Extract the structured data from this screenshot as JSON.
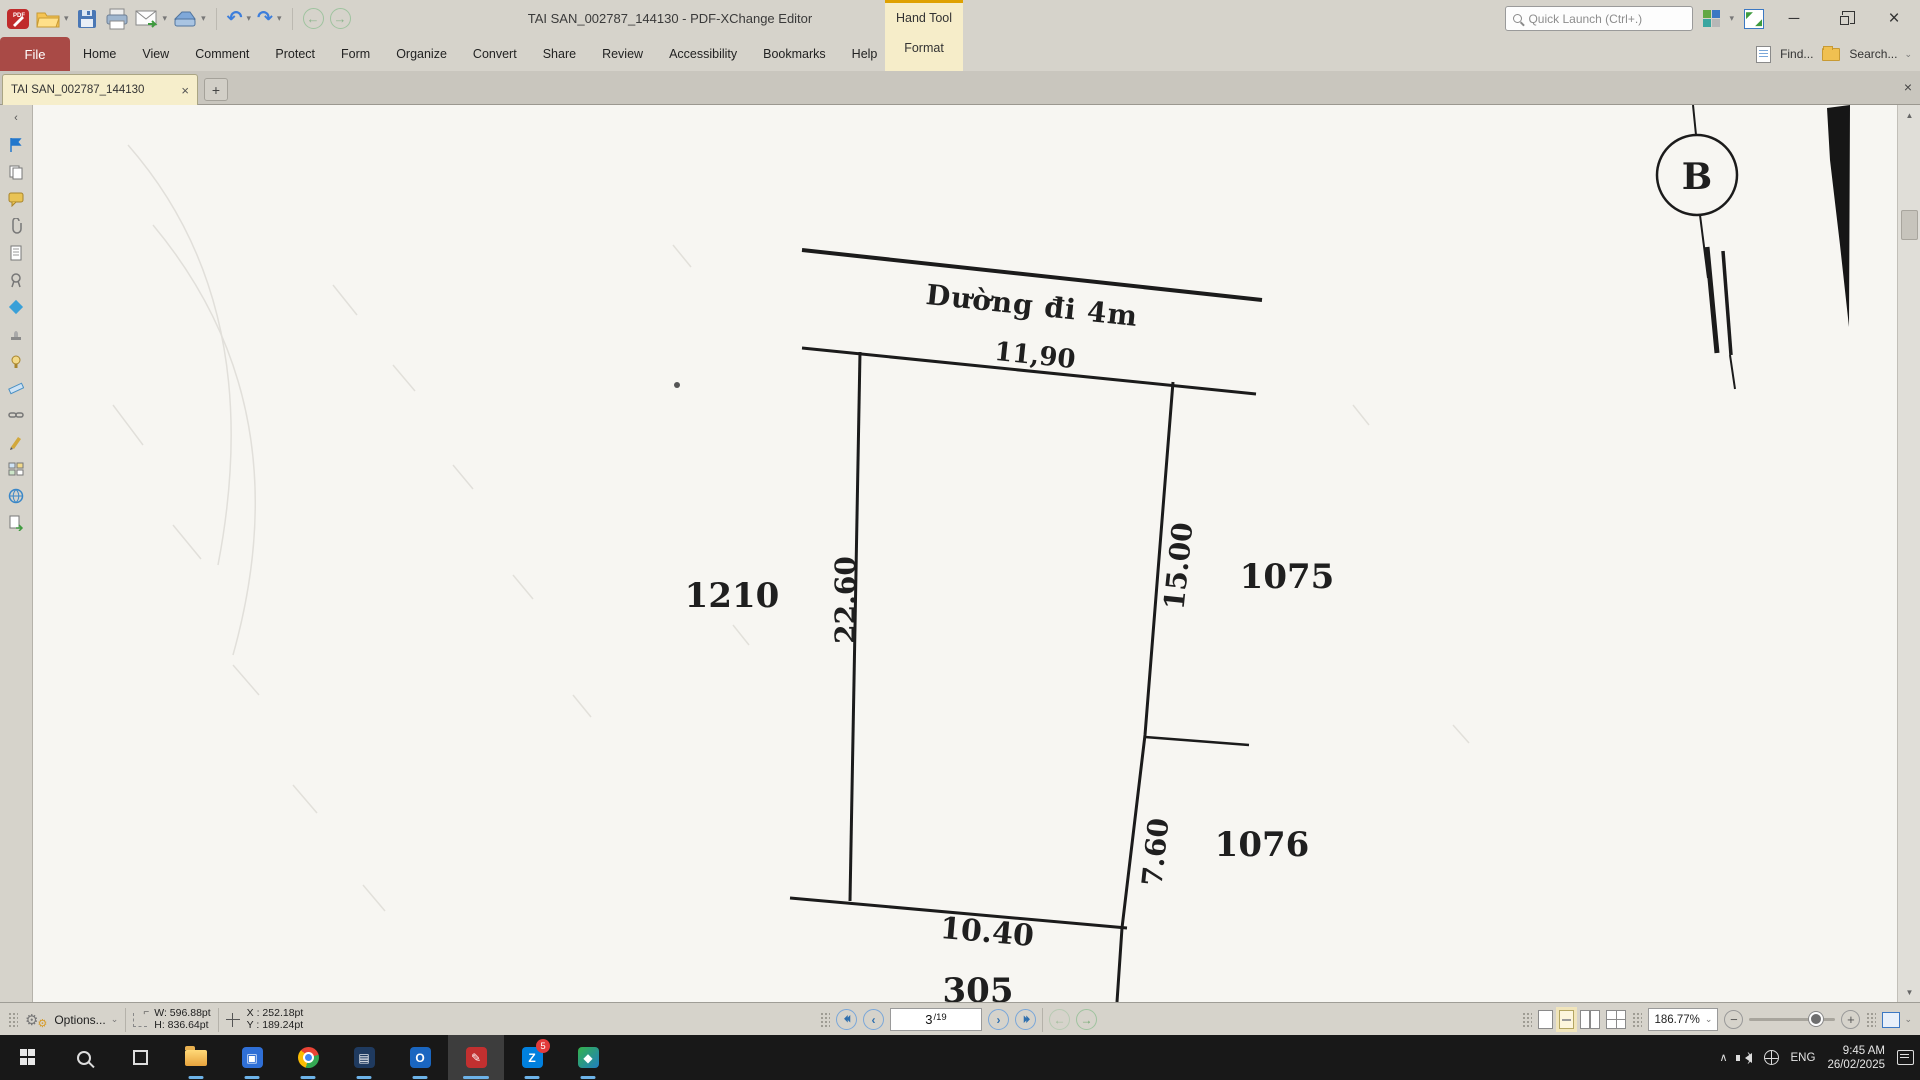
{
  "window": {
    "title": "TAI SAN_002787_144130 - PDF-XChange Editor",
    "minimize": "─",
    "close": "×"
  },
  "quick_launch": {
    "placeholder": "Quick Launch (Ctrl+.)"
  },
  "ribbon": {
    "hand_tool": "Hand Tool",
    "format": "Format",
    "find": "Find...",
    "search": "Search..."
  },
  "menus": [
    "File",
    "Home",
    "View",
    "Comment",
    "Protect",
    "Form",
    "Organize",
    "Convert",
    "Share",
    "Review",
    "Accessibility",
    "Bookmarks",
    "Help"
  ],
  "tab": {
    "title": "TAI SAN_002787_144130",
    "close": "×",
    "new_tab": "+"
  },
  "drawing": {
    "road_label": "Dường đi 4m",
    "road_width_dim": "11,90",
    "left_dim": "22.60",
    "right_dim_upper": "15.00",
    "right_dim_lower": "7.60",
    "bottom_dim": "10.40",
    "bottom_cut_dim": "305",
    "parcel_left": "1210",
    "parcel_right_upper": "1075",
    "parcel_right_lower": "1076",
    "marker": "B"
  },
  "status": {
    "options": "Options...",
    "width": "W: 596.88pt",
    "height": "H: 836.64pt",
    "pos_x": "X : 252.18pt",
    "pos_y": "Y : 189.24pt",
    "page_current": "3",
    "page_total": "/19",
    "zoom": "186.77%"
  },
  "taskbar": {
    "lang": "ENG",
    "time": "9:45 AM",
    "date": "26/02/2025",
    "zalo_letter": "Z",
    "zalo_badge": "5",
    "outlook_letter": "O"
  },
  "icons": {
    "caret_down": "▾",
    "chevron_down": "⌄",
    "undo": "↶",
    "redo": "↷",
    "back": "←",
    "forward": "→",
    "nav_first": "⏴⏴",
    "nav_prev": "‹",
    "nav_next": "›",
    "nav_last": "⏵⏵",
    "up": "▲",
    "down": "▼",
    "collapse": "‹",
    "minus": "−",
    "plus": "+",
    "tray_chevron": "∧",
    "expand_tl": "◤",
    "expand_br": "◢"
  }
}
